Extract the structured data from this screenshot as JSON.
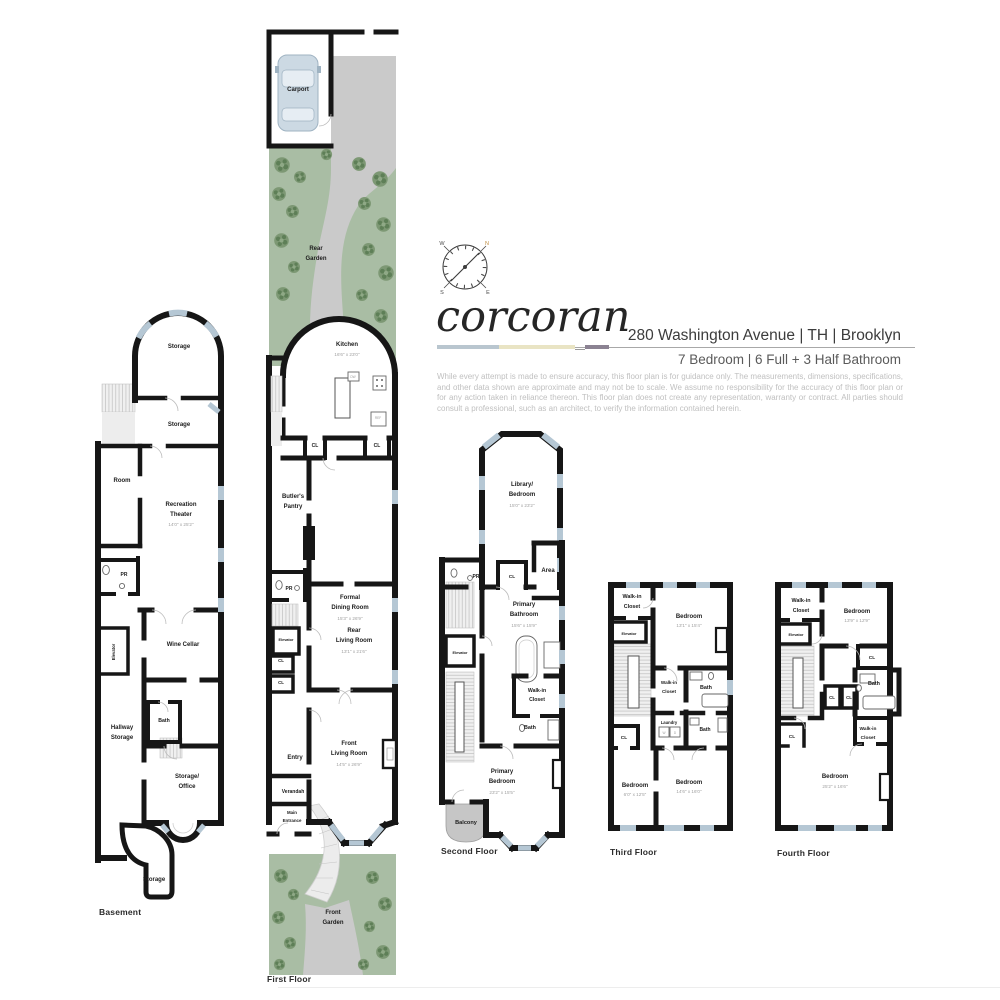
{
  "header": {
    "logo": "corcoran",
    "address": "280 Washington Avenue | TH | Brooklyn",
    "summary": "7 Bedroom | 6 Full + 3 Half Bathroom",
    "disclaimer": "While every attempt is made to ensure accuracy, this floor plan is for guidance only. The measurements, dimensions, specifications, and other data shown are approximate and may not be to scale. We assume no responsibility for the accuracy of this floor plan or for any action taken in reliance thereon. This floor plan does not create any representation, warranty or contract. All parties should consult a professional, such as an architect, to verify the information contained herein.",
    "compass": {
      "n": "N",
      "e": "E",
      "s": "S",
      "w": "W"
    }
  },
  "palette": {
    "wall": "#161616",
    "window": "#b5c7d4",
    "garden": "#a9bda4",
    "bush": "#6f8d67",
    "path": "#cacaca",
    "stairs": "#f0f0f0",
    "balcony": "#c6c6c6",
    "accent_blue": "#b9c6cf",
    "accent_cream": "#e9e4c4",
    "accent_gray": "#8b8292"
  },
  "floors": {
    "basement": {
      "caption": "Basement",
      "labels": [
        {
          "t": "Storage",
          "x": 91,
          "y": 40
        },
        {
          "t": "Storage",
          "x": 91,
          "y": 118
        },
        {
          "t": "Room",
          "x": 34,
          "y": 174
        },
        {
          "t": "Recreation",
          "x": 93,
          "y": 198
        },
        {
          "t": "Theater",
          "x": 93,
          "y": 208
        },
        {
          "t": "14'0\" x 25'2\"",
          "x": 93,
          "y": 218,
          "d": 1
        },
        {
          "t": "PR",
          "x": 36,
          "y": 268,
          "s": 5
        },
        {
          "t": "Elevator",
          "x": 27,
          "y": 344,
          "r": -90,
          "s": 4.2
        },
        {
          "t": "Wine Cellar",
          "x": 95,
          "y": 338
        },
        {
          "t": "Bath",
          "x": 76,
          "y": 414,
          "s": 5.2
        },
        {
          "t": "Hallway",
          "x": 34,
          "y": 421
        },
        {
          "t": "Storage",
          "x": 34,
          "y": 431
        },
        {
          "t": "Storage/",
          "x": 99,
          "y": 470
        },
        {
          "t": "Office",
          "x": 99,
          "y": 480
        },
        {
          "t": "Storage",
          "x": 66,
          "y": 573
        }
      ]
    },
    "first": {
      "caption": "First Floor",
      "labels": [
        {
          "t": "Carport",
          "x": 33,
          "y": 63
        },
        {
          "t": "Rear",
          "x": 51,
          "y": 222
        },
        {
          "t": "Garden",
          "x": 51,
          "y": 232
        },
        {
          "t": "Kitchen",
          "x": 82,
          "y": 318
        },
        {
          "t": "16'6\" x 23'0\"",
          "x": 82,
          "y": 328,
          "d": 1
        },
        {
          "t": "DW",
          "x": 88,
          "y": 350,
          "d": 1,
          "s": 3.2
        },
        {
          "t": "REF",
          "x": 113,
          "y": 391,
          "d": 1,
          "s": 3.2
        },
        {
          "t": "CL",
          "x": 50,
          "y": 419,
          "s": 5
        },
        {
          "t": "CL",
          "x": 112,
          "y": 419,
          "s": 5
        },
        {
          "t": "Butler's",
          "x": 28,
          "y": 470
        },
        {
          "t": "Pantry",
          "x": 28,
          "y": 480
        },
        {
          "t": "PR",
          "x": 24,
          "y": 562,
          "s": 5
        },
        {
          "t": "Formal",
          "x": 85,
          "y": 571
        },
        {
          "t": "Dining Room",
          "x": 85,
          "y": 581
        },
        {
          "t": "15'3\" x 26'9\"",
          "x": 85,
          "y": 592,
          "d": 1
        },
        {
          "t": "Elevator",
          "x": 21,
          "y": 613,
          "s": 3.8
        },
        {
          "t": "Rear",
          "x": 89,
          "y": 604
        },
        {
          "t": "Living Room",
          "x": 89,
          "y": 614
        },
        {
          "t": "13'1\" x 21'6\"",
          "x": 89,
          "y": 625,
          "d": 1
        },
        {
          "t": "CL",
          "x": 16,
          "y": 634,
          "s": 4.4
        },
        {
          "t": "CL",
          "x": 16,
          "y": 656,
          "s": 4.4
        },
        {
          "t": "Entry",
          "x": 30,
          "y": 731
        },
        {
          "t": "Front",
          "x": 84,
          "y": 717
        },
        {
          "t": "Living Room",
          "x": 84,
          "y": 727
        },
        {
          "t": "14'5\" x 26'9\"",
          "x": 84,
          "y": 738,
          "d": 1
        },
        {
          "t": "Verandah",
          "x": 28,
          "y": 765,
          "s": 5
        },
        {
          "t": "Main",
          "x": 27,
          "y": 786,
          "s": 4.4
        },
        {
          "t": "Entrance",
          "x": 27,
          "y": 794,
          "s": 4.4
        },
        {
          "t": "Front",
          "x": 68,
          "y": 886
        },
        {
          "t": "Garden",
          "x": 68,
          "y": 896
        }
      ]
    },
    "second": {
      "caption": "Second Floor",
      "labels": [
        {
          "t": "Library/",
          "x": 84,
          "y": 56
        },
        {
          "t": "Bedroom",
          "x": 84,
          "y": 66
        },
        {
          "t": "15'0\" x 23'2\"",
          "x": 84,
          "y": 77,
          "d": 1
        },
        {
          "t": "PR",
          "x": 38,
          "y": 148,
          "s": 5
        },
        {
          "t": "CL",
          "x": 74,
          "y": 148,
          "s": 4.8
        },
        {
          "t": "Area",
          "x": 110,
          "y": 142
        },
        {
          "t": "Primary",
          "x": 86,
          "y": 176
        },
        {
          "t": "Bathroom",
          "x": 86,
          "y": 186
        },
        {
          "t": "15'6\" x 15'9\"",
          "x": 86,
          "y": 197,
          "d": 1
        },
        {
          "t": "Elevator",
          "x": 22,
          "y": 224,
          "s": 3.8
        },
        {
          "t": "Walk-in",
          "x": 99,
          "y": 262,
          "s": 5.2
        },
        {
          "t": "Closet",
          "x": 99,
          "y": 271,
          "s": 5.2
        },
        {
          "t": "Bath",
          "x": 92,
          "y": 299,
          "s": 5.4
        },
        {
          "t": "Primary",
          "x": 64,
          "y": 343
        },
        {
          "t": "Bedroom",
          "x": 64,
          "y": 353
        },
        {
          "t": "23'2\" x 15'5\"",
          "x": 64,
          "y": 364,
          "d": 1
        },
        {
          "t": "Balcony",
          "x": 28,
          "y": 394,
          "s": 5.6
        }
      ]
    },
    "third": {
      "caption": "Third Floor",
      "labels": [
        {
          "t": "Walk-in",
          "x": 24,
          "y": 20,
          "s": 5.4
        },
        {
          "t": "Closet",
          "x": 24,
          "y": 30,
          "s": 5.4
        },
        {
          "t": "Bedroom",
          "x": 81,
          "y": 40
        },
        {
          "t": "13'1\" x 15'4\"",
          "x": 81,
          "y": 49,
          "d": 1
        },
        {
          "t": "Elevator",
          "x": 21,
          "y": 57,
          "s": 3.8
        },
        {
          "t": "Walk-in",
          "x": 61,
          "y": 106,
          "s": 4.6
        },
        {
          "t": "Closet",
          "x": 61,
          "y": 115,
          "s": 4.6
        },
        {
          "t": "Bath",
          "x": 98,
          "y": 111,
          "s": 5.4
        },
        {
          "t": "Laundry",
          "x": 61,
          "y": 146,
          "s": 4.2
        },
        {
          "t": "W",
          "x": 56,
          "y": 156,
          "d": 1,
          "s": 3.2
        },
        {
          "t": "D",
          "x": 67,
          "y": 156,
          "d": 1,
          "s": 3.2
        },
        {
          "t": "CL",
          "x": 16,
          "y": 161,
          "s": 4.8
        },
        {
          "t": "Bath",
          "x": 97,
          "y": 153,
          "s": 5
        },
        {
          "t": "Bedroom",
          "x": 27,
          "y": 209
        },
        {
          "t": "6'0\" x 12'5\"",
          "x": 27,
          "y": 218,
          "d": 1
        },
        {
          "t": "Bedroom",
          "x": 81,
          "y": 206
        },
        {
          "t": "14'6\" x 16'0\"",
          "x": 81,
          "y": 215,
          "d": 1
        }
      ]
    },
    "fourth": {
      "caption": "Fourth Floor",
      "labels": [
        {
          "t": "Walk-in",
          "x": 31,
          "y": 24,
          "s": 5.4
        },
        {
          "t": "Closet",
          "x": 31,
          "y": 34,
          "s": 5.4
        },
        {
          "t": "Bedroom",
          "x": 87,
          "y": 35
        },
        {
          "t": "13'9\" x 12'9\"",
          "x": 87,
          "y": 44,
          "d": 1
        },
        {
          "t": "Elevator",
          "x": 26,
          "y": 58,
          "s": 3.8
        },
        {
          "t": "CL",
          "x": 102,
          "y": 81,
          "s": 4.8
        },
        {
          "t": "Bath",
          "x": 104,
          "y": 107,
          "s": 5.4
        },
        {
          "t": "CL",
          "x": 62,
          "y": 121,
          "s": 4.4
        },
        {
          "t": "CL",
          "x": 79,
          "y": 121,
          "s": 4.4
        },
        {
          "t": "Walk-in",
          "x": 98,
          "y": 152,
          "s": 4.8
        },
        {
          "t": "Closet",
          "x": 98,
          "y": 161,
          "s": 4.8
        },
        {
          "t": "CL",
          "x": 22,
          "y": 160,
          "s": 4.8
        },
        {
          "t": "Bedroom",
          "x": 65,
          "y": 200
        },
        {
          "t": "25'2\" x 16'6\"",
          "x": 65,
          "y": 210,
          "d": 1
        }
      ]
    }
  }
}
